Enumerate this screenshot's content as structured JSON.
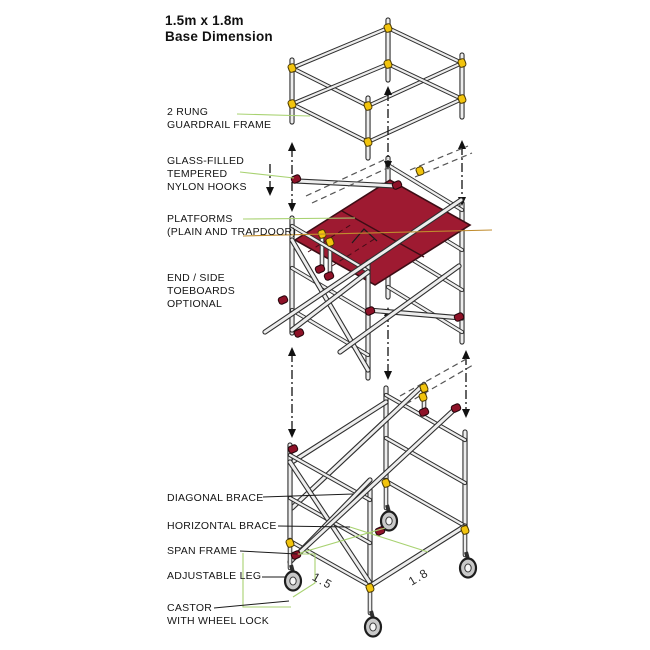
{
  "title": {
    "line1": "1.5m x 1.8m",
    "line2": "Base Dimension"
  },
  "labels": [
    {
      "id": "guardrail-frame",
      "lines": [
        "2 RUNG",
        "GUARDRAIL FRAME"
      ]
    },
    {
      "id": "nylon-hooks",
      "lines": [
        "GLASS-FILLED",
        "TEMPERED",
        "NYLON HOOKS"
      ]
    },
    {
      "id": "platforms",
      "lines": [
        "PLATFORMS",
        "(PLAIN AND TRAPDOOR)"
      ]
    },
    {
      "id": "toeboards",
      "lines": [
        "END / SIDE",
        "TOEBOARDS",
        "OPTIONAL"
      ]
    },
    {
      "id": "diagonal-brace",
      "lines": [
        "DIAGONAL BRACE"
      ]
    },
    {
      "id": "horizontal-brace",
      "lines": [
        "HORIZONTAL BRACE"
      ]
    },
    {
      "id": "span-frame",
      "lines": [
        "SPAN FRAME"
      ]
    },
    {
      "id": "adjustable-leg",
      "lines": [
        "ADJUSTABLE LEG"
      ]
    },
    {
      "id": "castor",
      "lines": [
        "CASTOR",
        "WITH WHEEL LOCK"
      ]
    }
  ],
  "dimensions": {
    "depth": "1.5",
    "width": "1.8"
  },
  "colors": {
    "platform_red": "#9e1a31",
    "platform_edge": "#3d0d15",
    "clamp_yellow": "#f2c40d",
    "clamp_edge": "#4a3800",
    "coupler_red": "#8e1228",
    "coupler_edge": "#23040a",
    "leader_green": "#a8d271",
    "leader_orange": "#c08c2e",
    "leader_black": "#1a1a1a",
    "tube_fill": "#ededed",
    "tube_outline": "#2f2f2f",
    "arrow_black": "#111111",
    "ghost_gray": "#555555",
    "castor_gray": "#c9c9c9",
    "text_black": "#151515"
  }
}
